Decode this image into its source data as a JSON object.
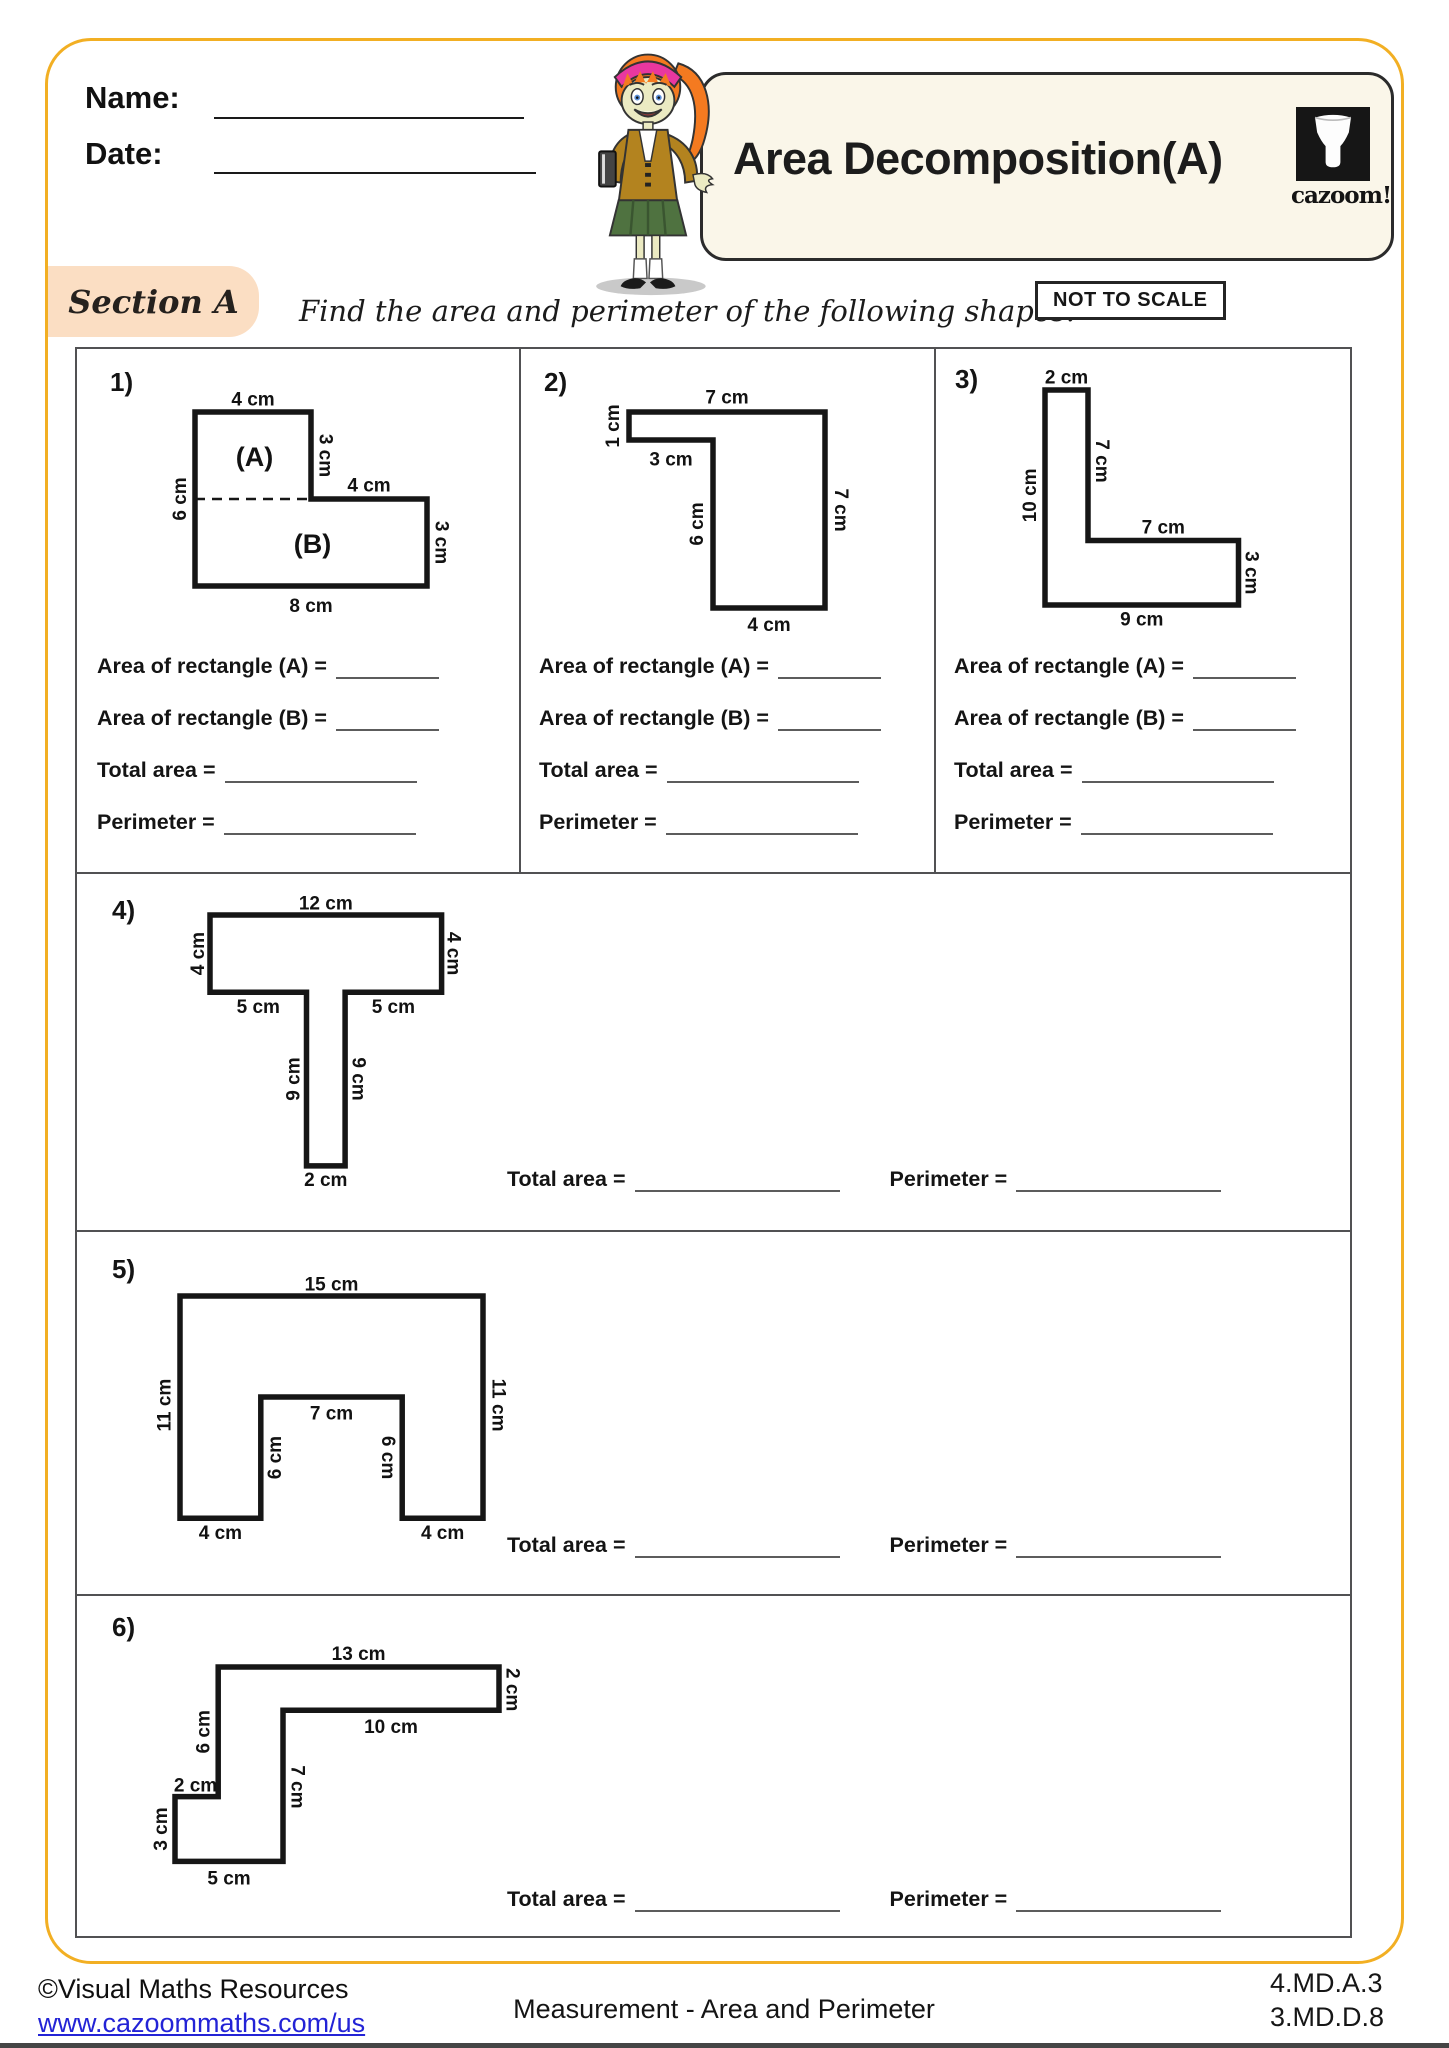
{
  "colors": {
    "frame_yellow": "#F2AF23",
    "section_peach": "#FBDEC3",
    "title_cream": "#FAF6E9",
    "link_blue": "#2323D6",
    "ink": "#161616",
    "table_gray": "#515153"
  },
  "header": {
    "name_label": "Name:",
    "date_label": "Date:",
    "title": "Area Decomposition(A)",
    "logo_text": "cazoom!"
  },
  "section": {
    "label": "Section A",
    "instruction": "Find the area and perimeter of the following shapes.",
    "not_to_scale": "NOT TO SCALE"
  },
  "answer_labels": {
    "area_a": "Area of rectangle (A) =",
    "area_b": "Area of rectangle (B) =",
    "total": "Total area =",
    "perimeter": "Perimeter ="
  },
  "problems": [
    {
      "number": "1)",
      "shape": {
        "scale": 29,
        "ox": 68,
        "oy": 48,
        "w": 350,
        "h": 275,
        "points": [
          [
            0,
            0
          ],
          [
            4,
            0
          ],
          [
            4,
            3
          ],
          [
            8,
            3
          ],
          [
            8,
            6
          ],
          [
            0,
            6
          ]
        ],
        "dash": [
          [
            0,
            3
          ],
          [
            4,
            3
          ]
        ],
        "labels": [
          {
            "t": "4 cm",
            "x": 2,
            "y": -0.42
          },
          {
            "t": "3 cm",
            "x": 4.48,
            "y": 1.5,
            "r": 90
          },
          {
            "t": "4 cm",
            "x": 6,
            "y": 2.56
          },
          {
            "t": "3 cm",
            "x": 8.48,
            "y": 4.5,
            "r": 90
          },
          {
            "t": "8 cm",
            "x": 4,
            "y": 6.7
          },
          {
            "t": "6 cm",
            "x": -0.5,
            "y": 3,
            "r": -90
          },
          {
            "t": "(A)",
            "x": 2.05,
            "y": 1.55,
            "s": 27
          },
          {
            "t": "(B)",
            "x": 4.05,
            "y": 4.55,
            "s": 27
          }
        ]
      }
    },
    {
      "number": "2)",
      "shape": {
        "scale": 28,
        "ox": 72,
        "oy": 38,
        "w": 330,
        "h": 275,
        "points": [
          [
            0,
            0
          ],
          [
            7,
            0
          ],
          [
            7,
            7
          ],
          [
            3,
            7
          ],
          [
            3,
            1
          ],
          [
            0,
            1
          ]
        ],
        "labels": [
          {
            "t": "7 cm",
            "x": 3.5,
            "y": -0.5
          },
          {
            "t": "1 cm",
            "x": -0.55,
            "y": 0.5,
            "r": -90
          },
          {
            "t": "3 cm",
            "x": 1.5,
            "y": 1.72
          },
          {
            "t": "6 cm",
            "x": 2.45,
            "y": 4,
            "r": -90
          },
          {
            "t": "7 cm",
            "x": 7.55,
            "y": 3.5,
            "r": 90
          },
          {
            "t": "4 cm",
            "x": 5,
            "y": 7.62
          }
        ]
      }
    },
    {
      "number": "3)",
      "shape": {
        "scale": 21.5,
        "ox": 78,
        "oy": 28,
        "w": 335,
        "h": 285,
        "points": [
          [
            0,
            0
          ],
          [
            2,
            0
          ],
          [
            2,
            7
          ],
          [
            9,
            7
          ],
          [
            9,
            10
          ],
          [
            0,
            10
          ]
        ],
        "labels": [
          {
            "t": "2 cm",
            "x": 1,
            "y": -0.55
          },
          {
            "t": "7 cm",
            "x": 2.62,
            "y": 3.3,
            "r": 90
          },
          {
            "t": "10 cm",
            "x": -0.68,
            "y": 4.9,
            "r": -90
          },
          {
            "t": "7 cm",
            "x": 5.5,
            "y": 6.42
          },
          {
            "t": "3 cm",
            "x": 9.58,
            "y": 8.5,
            "r": 90
          },
          {
            "t": "9 cm",
            "x": 4.5,
            "y": 10.7
          }
        ]
      }
    },
    {
      "number": "4)",
      "shape": {
        "scale": 19.3,
        "ox": 68,
        "oy": 33,
        "w": 345,
        "h": 325,
        "points": [
          [
            0,
            0
          ],
          [
            12,
            0
          ],
          [
            12,
            4
          ],
          [
            7,
            4
          ],
          [
            7,
            13
          ],
          [
            5,
            13
          ],
          [
            5,
            4
          ],
          [
            0,
            4
          ]
        ],
        "labels": [
          {
            "t": "12 cm",
            "x": 6,
            "y": -0.58
          },
          {
            "t": "4 cm",
            "x": -0.6,
            "y": 2,
            "r": -90
          },
          {
            "t": "4 cm",
            "x": 12.6,
            "y": 2,
            "r": 90
          },
          {
            "t": "5 cm",
            "x": 2.5,
            "y": 4.8
          },
          {
            "t": "5 cm",
            "x": 9.5,
            "y": 4.8
          },
          {
            "t": "9 cm",
            "x": 4.35,
            "y": 8.5,
            "r": -90
          },
          {
            "t": "9 cm",
            "x": 7.68,
            "y": 8.5,
            "r": 90
          },
          {
            "t": "2 cm",
            "x": 6,
            "y": 13.75
          }
        ]
      }
    },
    {
      "number": "5)",
      "shape": {
        "scale": 20.2,
        "ox": 68,
        "oy": 46,
        "w": 420,
        "h": 305,
        "points": [
          [
            0,
            0
          ],
          [
            15,
            0
          ],
          [
            15,
            11
          ],
          [
            11,
            11
          ],
          [
            11,
            5
          ],
          [
            4,
            5
          ],
          [
            4,
            11
          ],
          [
            0,
            11
          ]
        ],
        "labels": [
          {
            "t": "15 cm",
            "x": 7.5,
            "y": -0.55
          },
          {
            "t": "11 cm",
            "x": -0.75,
            "y": 5.4,
            "r": -90
          },
          {
            "t": "11 cm",
            "x": 15.75,
            "y": 5.4,
            "r": 90
          },
          {
            "t": "7 cm",
            "x": 7.5,
            "y": 5.85
          },
          {
            "t": "6 cm",
            "x": 4.72,
            "y": 8,
            "r": -90
          },
          {
            "t": "6 cm",
            "x": 10.28,
            "y": 8,
            "r": 90
          },
          {
            "t": "4 cm",
            "x": 2,
            "y": 11.75
          },
          {
            "t": "4 cm",
            "x": 13,
            "y": 11.75
          }
        ]
      }
    },
    {
      "number": "6)",
      "shape": {
        "scale": 21.6,
        "ox": 43,
        "oy": 47,
        "w": 430,
        "h": 290,
        "points": [
          [
            2,
            0
          ],
          [
            15,
            0
          ],
          [
            15,
            2
          ],
          [
            5,
            2
          ],
          [
            5,
            9
          ],
          [
            0,
            9
          ],
          [
            0,
            6
          ],
          [
            2,
            6
          ]
        ],
        "labels": [
          {
            "t": "13 cm",
            "x": 8.5,
            "y": -0.58
          },
          {
            "t": "2 cm",
            "x": 15.6,
            "y": 1.05,
            "r": 90
          },
          {
            "t": "10 cm",
            "x": 10,
            "y": 2.8
          },
          {
            "t": "6 cm",
            "x": 1.35,
            "y": 3,
            "r": -90
          },
          {
            "t": "7 cm",
            "x": 5.65,
            "y": 5.55,
            "r": 90
          },
          {
            "t": "2 cm",
            "x": 0.95,
            "y": 5.5
          },
          {
            "t": "3 cm",
            "x": -0.62,
            "y": 7.5,
            "r": -90
          },
          {
            "t": "5 cm",
            "x": 2.5,
            "y": 9.82
          }
        ]
      }
    }
  ],
  "footer": {
    "copyright": "©Visual Maths Resources",
    "url": "www.cazoommaths.com/us",
    "center": "Measurement - Area and Perimeter",
    "standards": [
      "4.MD.A.3",
      "3.MD.D.8"
    ]
  }
}
